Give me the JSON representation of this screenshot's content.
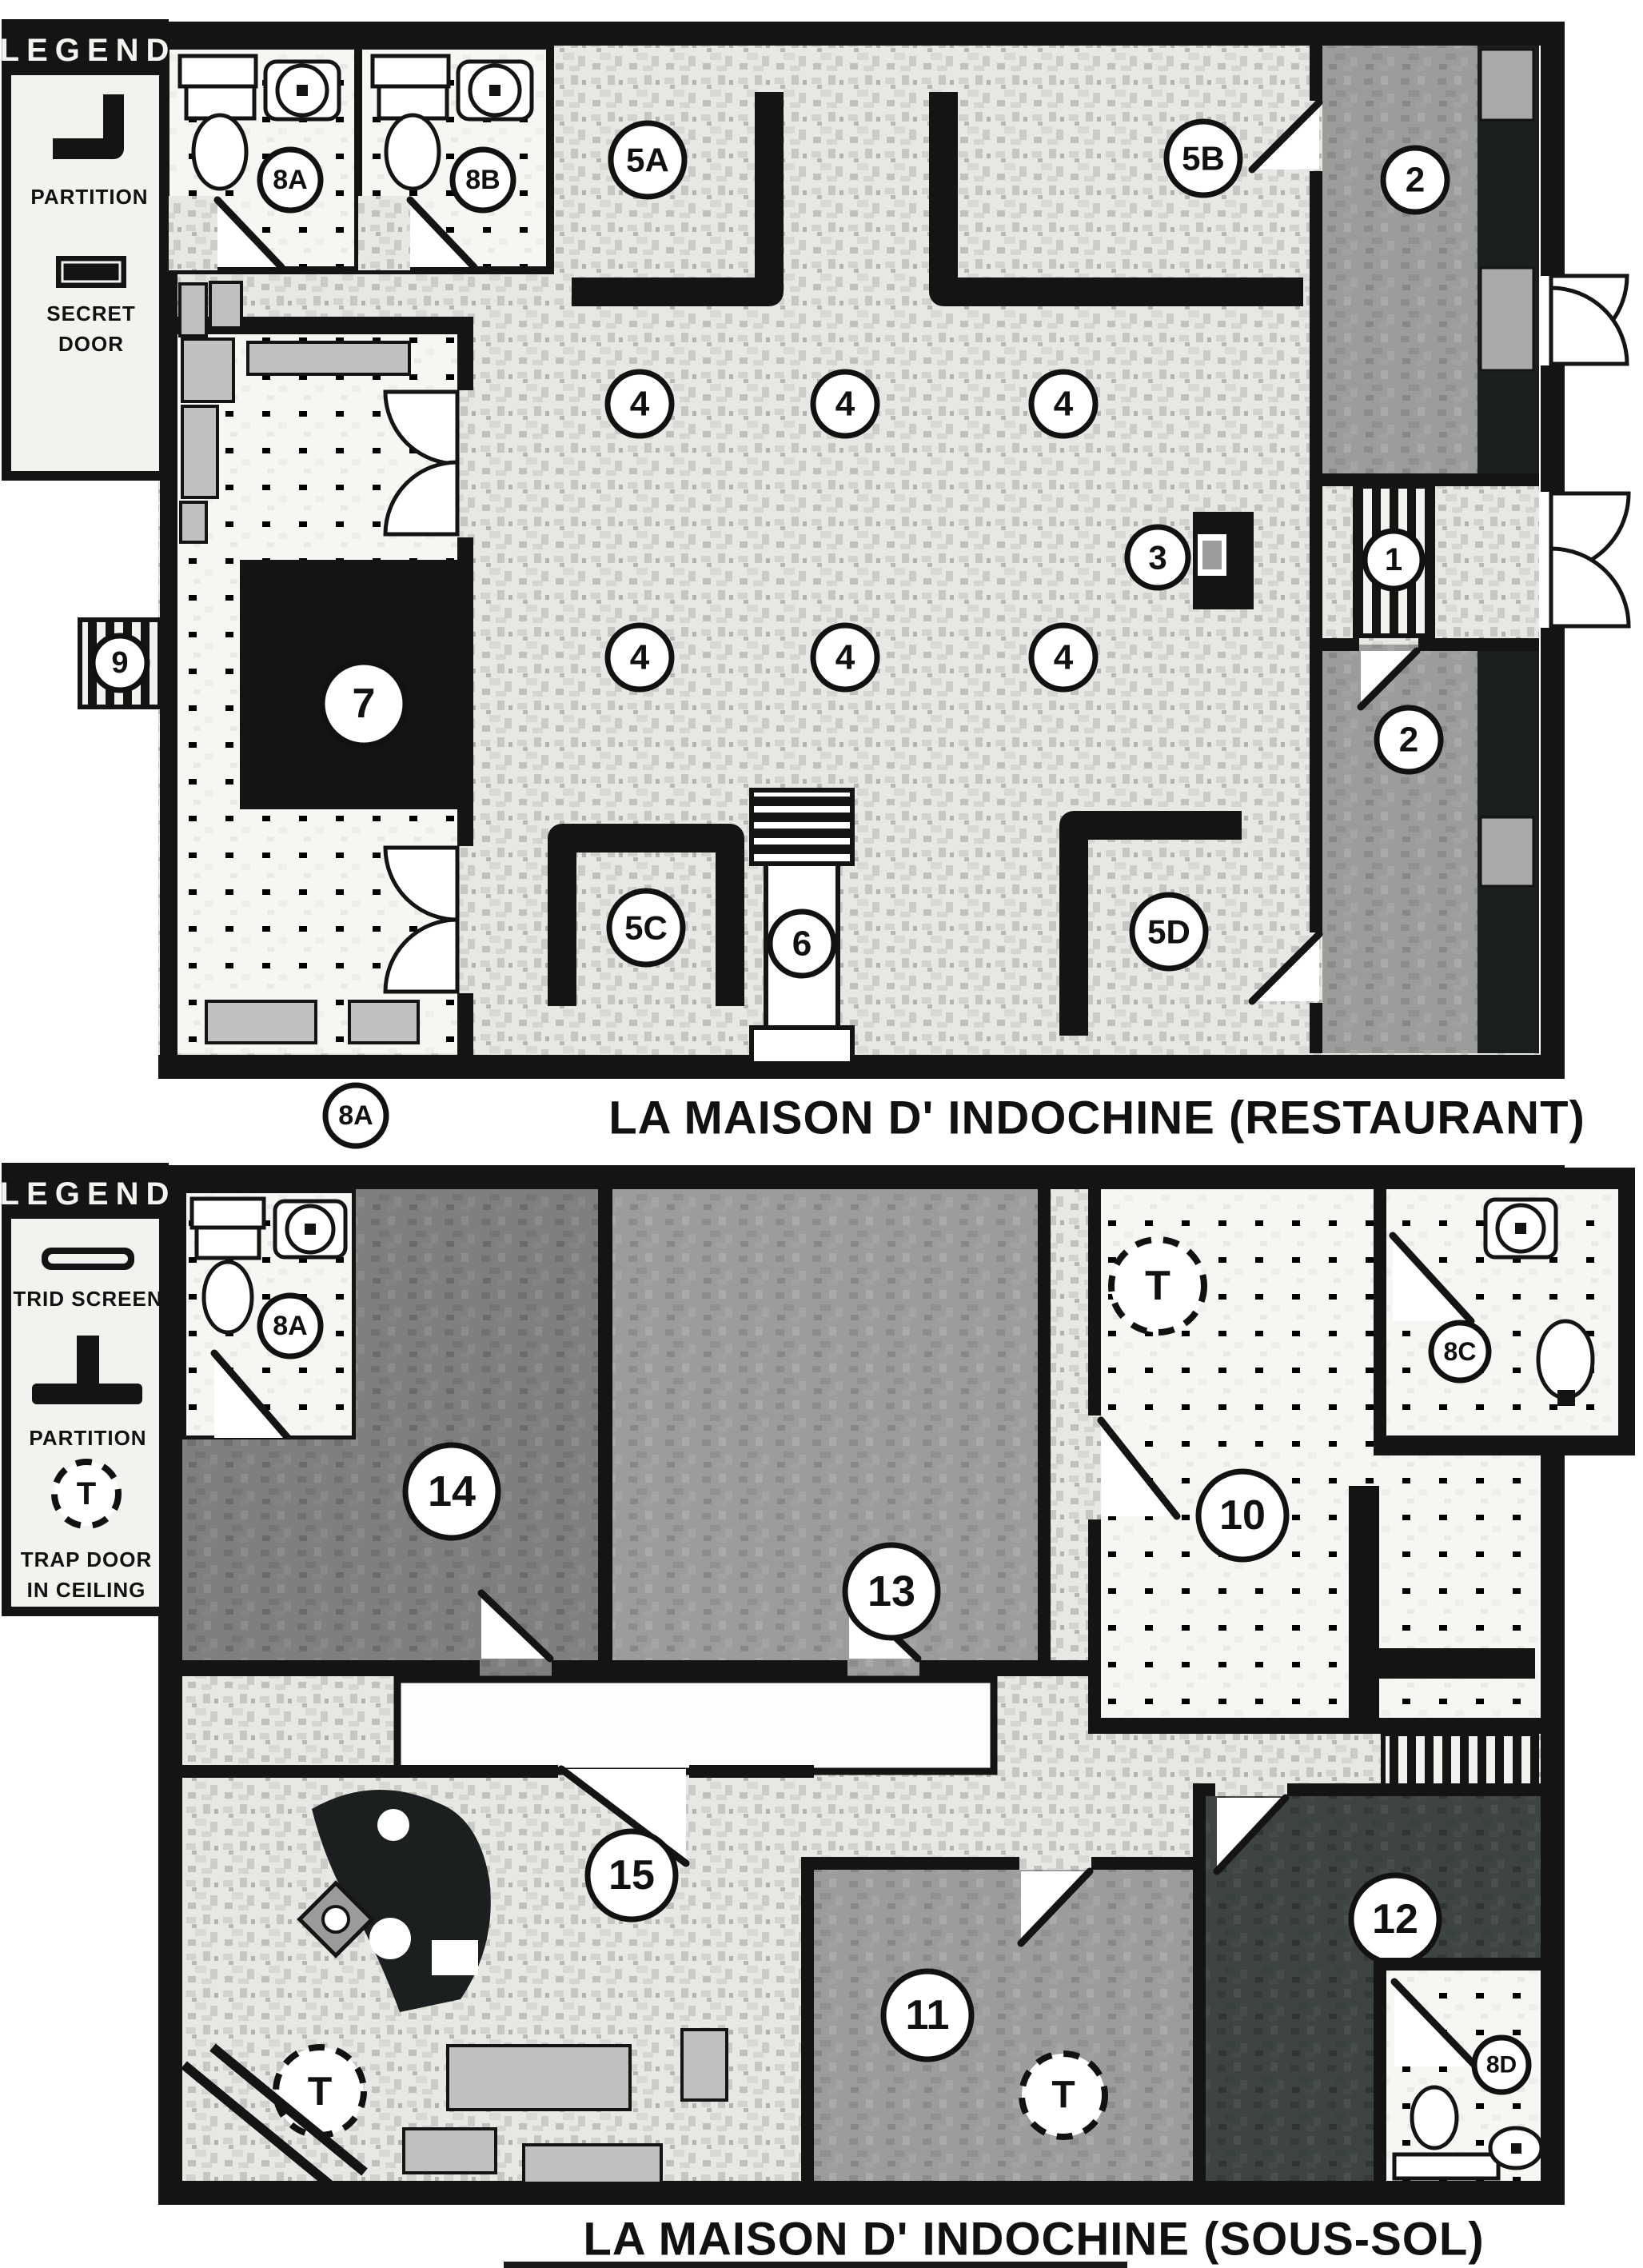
{
  "colors": {
    "wall": "#141414",
    "floor_light": "#e7e7e4",
    "floor_mid": "#9b9d9b",
    "floor_dark": "#7e807e",
    "floor_very_dark": "#3e4444",
    "room_white": "#f6f6f3",
    "counter_gray": "#bfc1bf"
  },
  "legend_restaurant": {
    "header": "LEGEND",
    "partition_label": "PARTITION",
    "secret_door_label": [
      "SECRET",
      "DOOR"
    ]
  },
  "legend_sous_sol": {
    "header": "LEGEND",
    "trid_label": "TRID SCREEN",
    "partition_label": "PARTITION",
    "trap_symbol": "T",
    "trap_label": [
      "TRAP DOOR",
      "IN CEILING"
    ]
  },
  "restaurant": {
    "title": "LA MAISON  D' INDOCHINE (RESTAURANT)",
    "labels": {
      "bath_a": "8A",
      "bath_b": "8B",
      "booth_a": "5A",
      "booth_b": "5B",
      "booth_c": "5C",
      "booth_d": "5D",
      "corridor_top": "2",
      "corridor_bottom": "2",
      "host_stand": "3",
      "vestibule": "1",
      "stage": "6",
      "kitchen_island": "7",
      "service_hatch": "9",
      "stairs_down": "8A",
      "tables": [
        "4",
        "4",
        "4",
        "4",
        "4",
        "4"
      ]
    }
  },
  "sous_sol": {
    "title": "LA MAISON D' INDOCHINE (SOUS-SOL)",
    "labels": {
      "bath_a": "8A",
      "bath_c": "8C",
      "bath_d": "8D",
      "room_14": "14",
      "room_13": "13",
      "room_10": "10",
      "room_15": "15",
      "room_11": "11",
      "room_12": "12",
      "trap_10": "T",
      "trap_15": "T",
      "trap_11": "T"
    }
  }
}
